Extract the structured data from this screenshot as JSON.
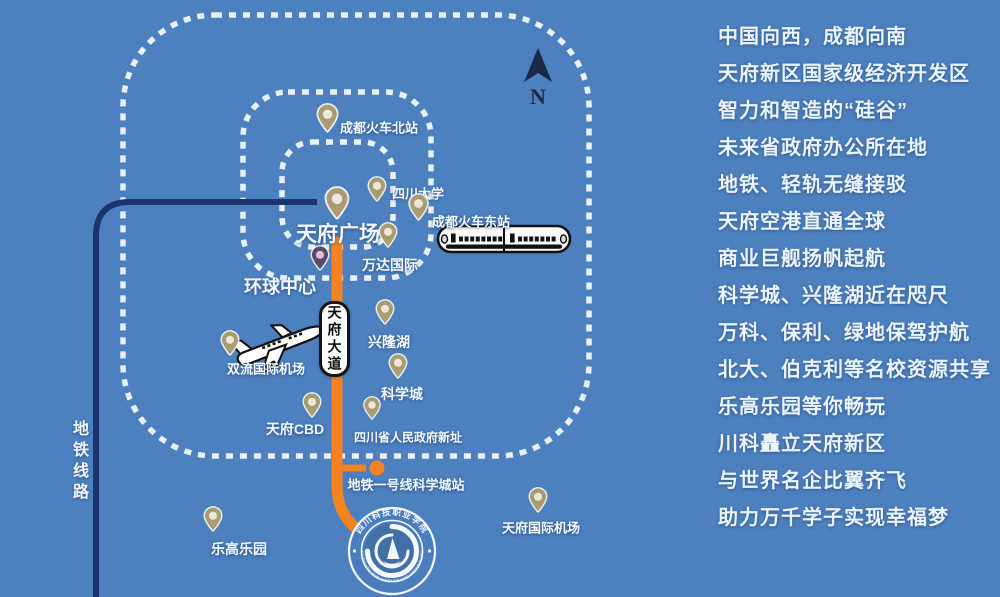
{
  "map": {
    "compass_label": "N",
    "metro_line_label": "地铁线路",
    "road_sign_label": "天府大道",
    "metro_station_label": "地铁一号线科学城站",
    "colors": {
      "background": "#4d80bf",
      "dashed_border": "#e7f1f7",
      "metro_line_navy": "#1a3569",
      "road_orange": "#f58220",
      "pin_khaki": "#a99c72",
      "pin_purple": "#5e4a68",
      "sign_white": "#fcfcfa",
      "label_white": "#f3f9fd"
    },
    "pins": [
      {
        "id": "chengdu-north-railway-station",
        "label": "成都火车北站",
        "x": 327,
        "tip": 133,
        "h": 30,
        "color": "khaki",
        "lx": 379,
        "ly": 127,
        "fs": 13
      },
      {
        "id": "sichuan-university",
        "label": "四川大学",
        "x": 377,
        "tip": 202,
        "h": 26,
        "color": "khaki",
        "lx": 418,
        "ly": 193,
        "fs": 13
      },
      {
        "id": "chengdu-east-railway-station",
        "label": "成都火车东站",
        "x": 418,
        "tip": 221,
        "h": 28,
        "color": "khaki",
        "lx": 471,
        "ly": 221,
        "fs": 13
      },
      {
        "id": "tianfu-square",
        "label": "天府广场",
        "x": 337,
        "tip": 220,
        "h": 34,
        "color": "khaki",
        "lx": 338,
        "ly": 233,
        "fs": 21
      },
      {
        "id": "wanda-international",
        "label": "万达国际",
        "x": 388,
        "tip": 248,
        "h": 26,
        "color": "khaki",
        "lx": 390,
        "ly": 265,
        "fs": 14
      },
      {
        "id": "global-center",
        "label": "环球中心",
        "x": 320,
        "tip": 271,
        "h": 26,
        "color": "purple",
        "lx": 280,
        "ly": 286,
        "fs": 18
      },
      {
        "id": "xinglong-lake",
        "label": "兴隆湖",
        "x": 385,
        "tip": 325,
        "h": 26,
        "color": "khaki",
        "lx": 389,
        "ly": 342,
        "fs": 14
      },
      {
        "id": "shuangliu-international-airport",
        "label": "双流国际机场",
        "x": 230,
        "tip": 356,
        "h": 26,
        "color": "khaki",
        "lx": 266,
        "ly": 368,
        "fs": 13
      },
      {
        "id": "science-city",
        "label": "科学城",
        "x": 398,
        "tip": 379,
        "h": 26,
        "color": "khaki",
        "lx": 402,
        "ly": 394,
        "fs": 14
      },
      {
        "id": "tianfu-cbd",
        "label": "天府CBD",
        "x": 312,
        "tip": 418,
        "h": 26,
        "color": "khaki",
        "lx": 295,
        "ly": 429,
        "fs": 14
      },
      {
        "id": "sichuan-provincial-government-new-site",
        "label": "四川省人民政府新址",
        "x": 372,
        "tip": 420,
        "h": 24,
        "color": "khaki",
        "lx": 408,
        "ly": 437,
        "fs": 12
      },
      {
        "id": "legoland",
        "label": "乐高乐园",
        "x": 213,
        "tip": 532,
        "h": 26,
        "color": "khaki",
        "lx": 239,
        "ly": 549,
        "fs": 14
      },
      {
        "id": "tianfu-international-airport",
        "label": "天府国际机场",
        "x": 538,
        "tip": 513,
        "h": 26,
        "color": "khaki",
        "lx": 541,
        "ly": 527,
        "fs": 13
      }
    ]
  },
  "headlines": {
    "lines": [
      "中国向西，成都向南",
      "天府新区国家级经济开发区",
      "智力和智造的“硅谷”",
      "未来省政府办公所在地",
      "地铁、轻轨无缝接驳",
      "天府空港直通全球",
      "商业巨舰扬帆起航",
      "科学城、兴隆湖近在咫尺",
      "万科、保利、绿地保驾护航",
      "北大、伯克利等名校资源共享",
      "乐高乐园等你畅玩",
      "川科矗立天府新区",
      "与世界名企比翼齐飞",
      "助力万千学子实现幸福梦"
    ]
  },
  "logo": {
    "top_text": "四川科技职业学院",
    "bottom_text": "UNIVERSITY FOR SCIENCE AND TECHNOLOGY"
  }
}
